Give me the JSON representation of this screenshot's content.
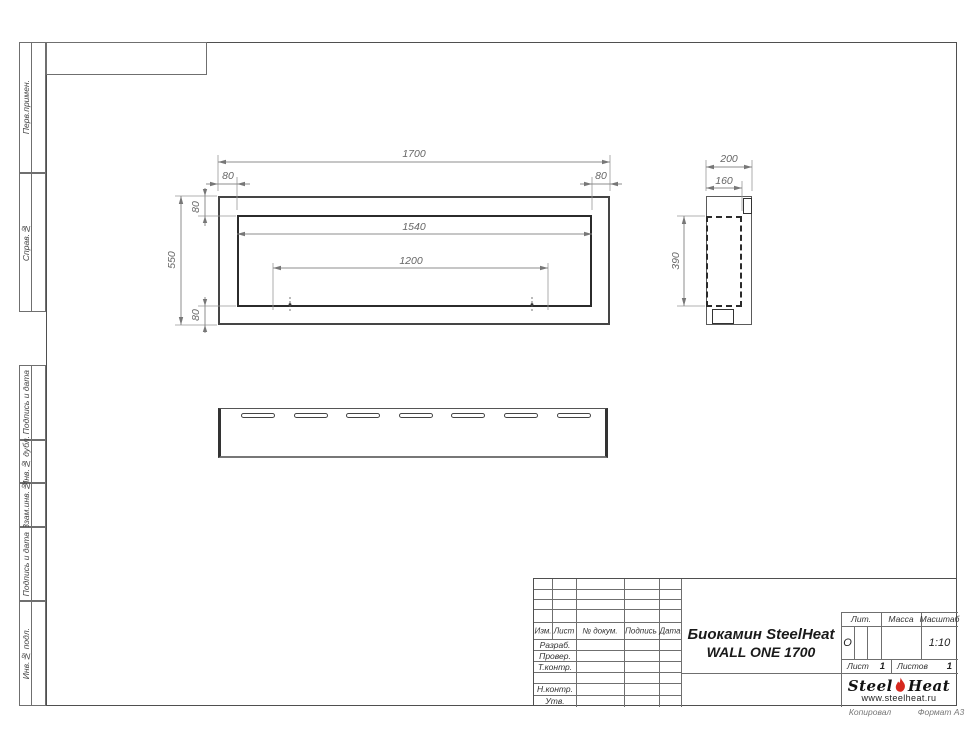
{
  "sheet": {
    "copied_label": "Копировал",
    "format_label": "Формат А3"
  },
  "side_column": {
    "sections": [
      {
        "label": "Перв.примен."
      },
      {
        "label": "Справ.№"
      },
      {
        "label": "Подпись и дата"
      },
      {
        "label": "Инв.№ дубл."
      },
      {
        "label": "Взам.инв.№"
      },
      {
        "label": "Подпись и дата"
      },
      {
        "label": "Инв.№ подл."
      }
    ]
  },
  "dims": {
    "front": {
      "total_width": "1700",
      "left_frame": "80",
      "right_frame": "80",
      "opening_width": "1540",
      "burner_width": "1200",
      "total_height": "550",
      "top_frame": "80",
      "bottom_frame": "80"
    },
    "side": {
      "depth": "200",
      "inner_depth": "160",
      "inner_height": "390"
    }
  },
  "bottom_view": {
    "slot_count": 7
  },
  "title_block": {
    "columns": {
      "izm": "Изм.",
      "list": "Лист",
      "doc": "№ докум.",
      "sign": "Подпись",
      "date": "Дата"
    },
    "rows": {
      "razrab": "Разраб.",
      "prover": "Провер.",
      "tkontr": "Т.контр.",
      "nkontr": "Н.контр.",
      "utv": "Утв."
    },
    "title_line1": "Биокамин SteelHeat",
    "title_line2": "WALL ONE 1700",
    "lit_label": "Лит.",
    "lit_value": "О",
    "mass_label": "Масса",
    "scale_label": "Масштаб",
    "scale_value": "1:10",
    "list_label": "Лист",
    "list_value": "1",
    "listov_label": "Листов",
    "listov_value": "1"
  },
  "logo": {
    "word1": "Steel",
    "word2": "Heat",
    "url": "www.steelheat.ru",
    "flame_color": "#d6281e"
  }
}
